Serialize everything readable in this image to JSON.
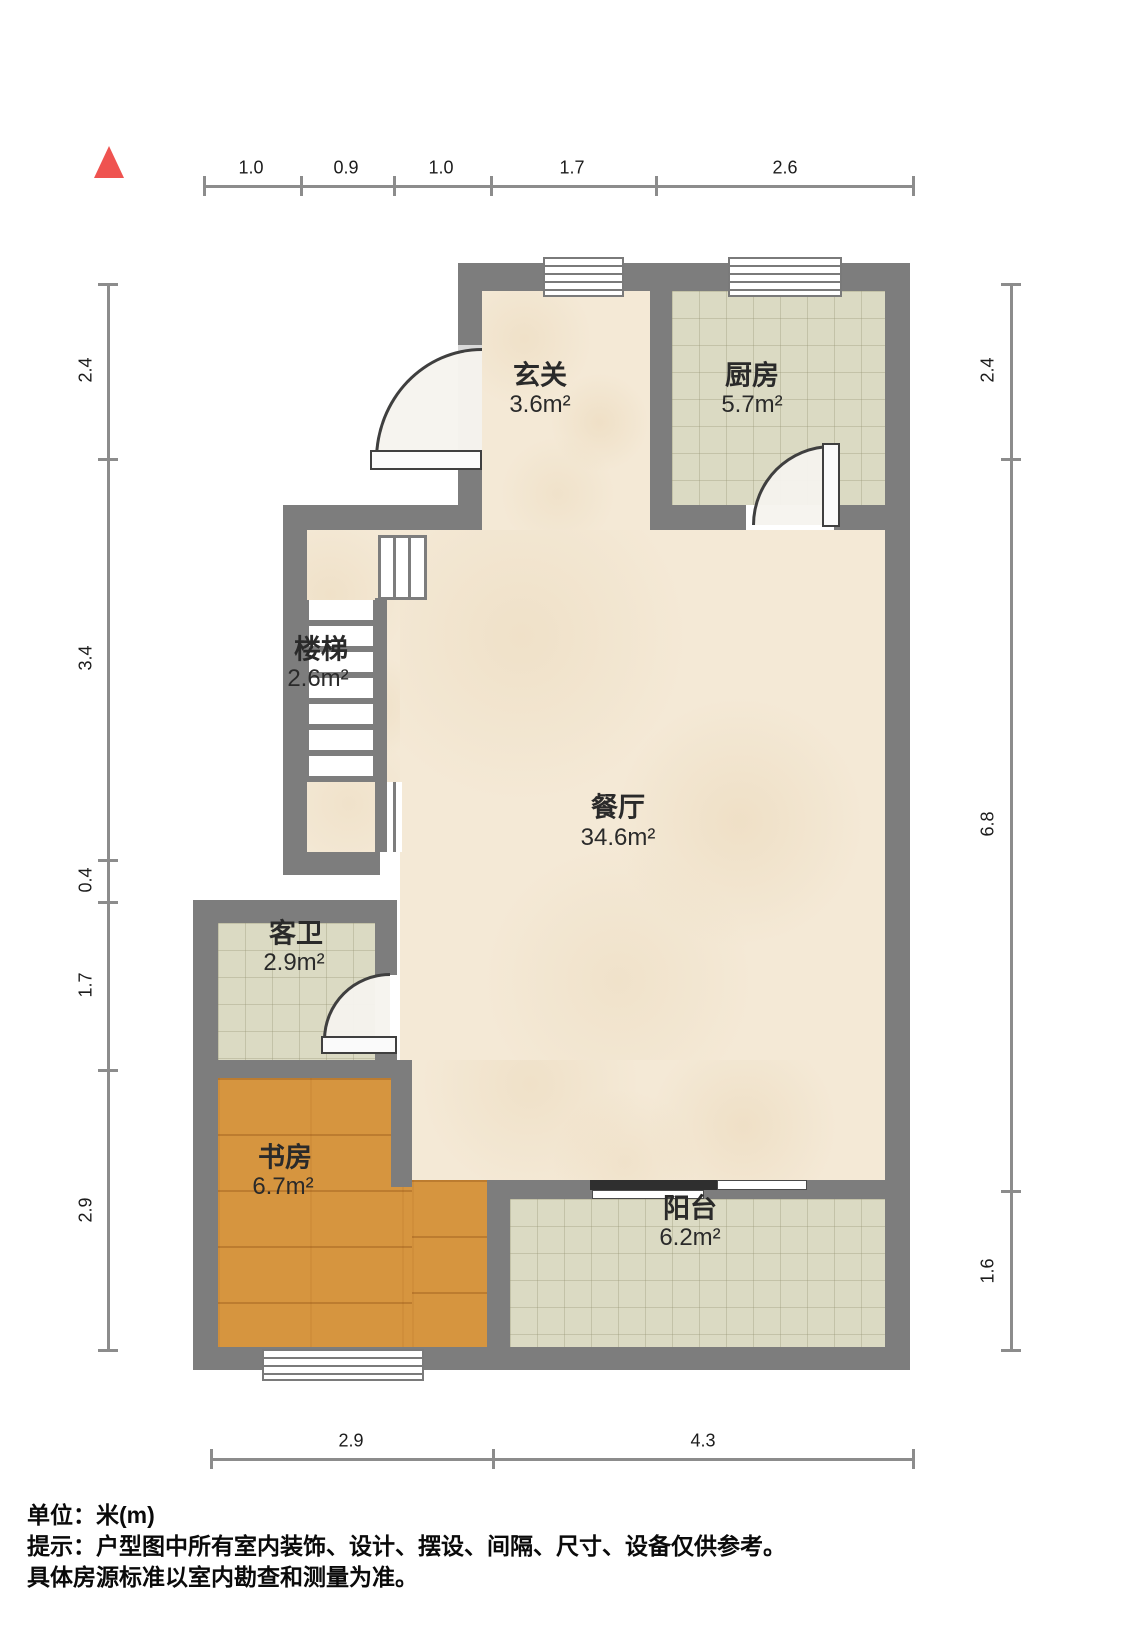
{
  "plan_title": "户型图",
  "north_indicator": "north-arrow",
  "dimensions": {
    "unit": "m",
    "top": [
      "1.0",
      "0.9",
      "1.0",
      "1.7",
      "2.6"
    ],
    "left": [
      "2.4",
      "3.4",
      "0.4",
      "1.7",
      "2.9"
    ],
    "right": [
      "2.4",
      "6.8",
      "1.6"
    ],
    "bottom": [
      "2.9",
      "4.3"
    ]
  },
  "rooms": [
    {
      "name": "玄关",
      "area": "3.6m²"
    },
    {
      "name": "厨房",
      "area": "5.7m²"
    },
    {
      "name": "楼梯",
      "area": "2.6m²"
    },
    {
      "name": "餐厅",
      "area": "34.6m²"
    },
    {
      "name": "客卫",
      "area": "2.9m²"
    },
    {
      "name": "书房",
      "area": "6.7m²"
    },
    {
      "name": "阳台",
      "area": "6.2m²"
    }
  ],
  "footer": {
    "unit_line": "单位：米(m)",
    "tip_line1": "提示：户型图中所有室内装饰、设计、摆设、间隔、尺寸、设备仅供参考。",
    "tip_line2": "具体房源标准以室内勘查和测量为准。"
  },
  "colors": {
    "wall": "#7d7d7d",
    "marble_floor": "#f4e9d6",
    "tile_floor": "#dbdac3",
    "wood_floor": "#d6953f",
    "north_arrow": "#ef5350",
    "dimension_line": "#8c8c8c"
  }
}
